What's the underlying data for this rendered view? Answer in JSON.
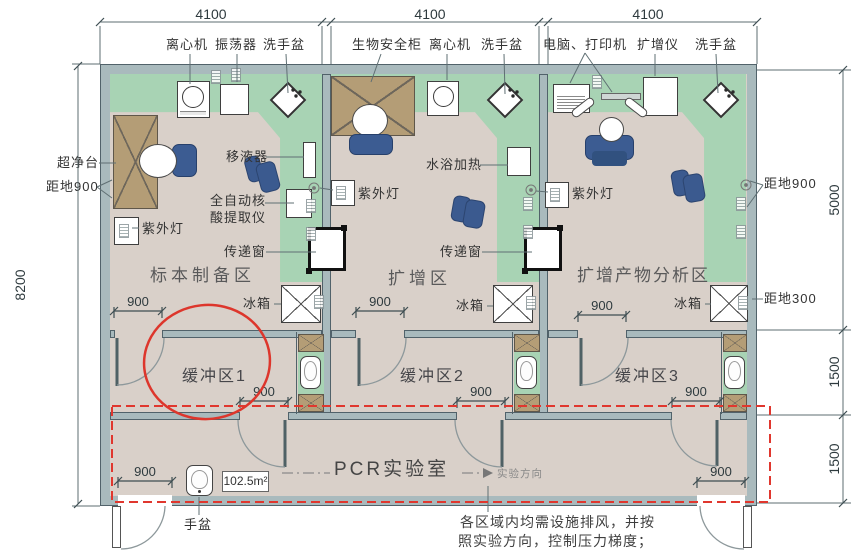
{
  "dims": {
    "w4100": "4100",
    "h8200": "8200",
    "h5000": "5000",
    "h1500": "1500",
    "d900": "900"
  },
  "equipment": {
    "centrifuge": "离心机",
    "shaker": "振荡器",
    "wash_basin": "洗手盆",
    "biosafety_cabinet": "生物安全柜",
    "computer_printer": "电脑、打印机",
    "amplifier": "扩增仪",
    "clean_bench": "超净台",
    "uv_lamp": "紫外灯",
    "pipette": "移液器",
    "extractor_line1": "全自动核",
    "extractor_line2": "酸提取仪",
    "pass_window": "传递窗",
    "water_bath": "水浴加热",
    "fridge": "冰箱",
    "hand_basin": "手盆"
  },
  "zones": {
    "room1": "标本制备区",
    "room2": "扩增区",
    "room3": "扩增产物分析区",
    "buffer1": "缓冲区1",
    "buffer2": "缓冲区2",
    "buffer3": "缓冲区3",
    "corridor": "PCR实验室"
  },
  "annotations": {
    "above_floor_900": "距地900",
    "above_floor_300": "距地300",
    "area": "102.5m²",
    "direction": "实验方向",
    "note_line1": "各区域内均需设施排风，并按",
    "note_line2": "照实验方向，控制压力梯度；"
  },
  "colors": {
    "wall": "#a9babd",
    "floor": "#d9d0c9",
    "bench": "#a8d3b4",
    "wood": "#b49d76",
    "equipment_blue": "#3c5c92",
    "highlight_red": "#e0372e"
  }
}
